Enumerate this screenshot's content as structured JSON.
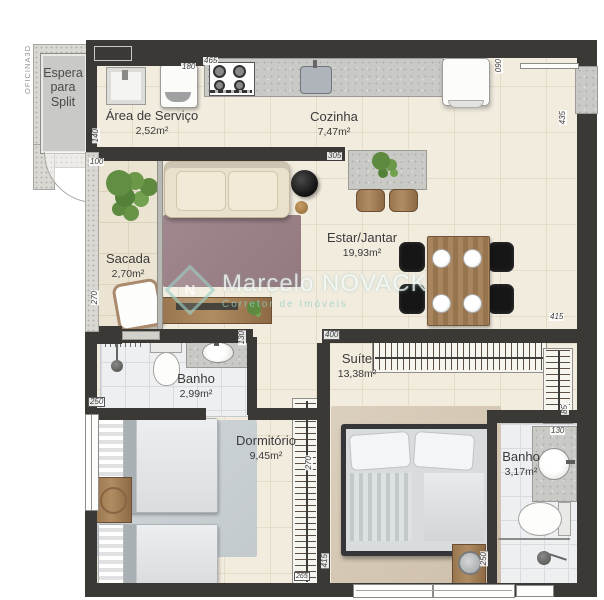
{
  "meta": {
    "brand": "OFICINA3D",
    "type": "apartment floor plan"
  },
  "watermark": {
    "title": "Marcelo NOVACK",
    "subtitle": "Corretor de Imóveis",
    "accent_color": "#96cdc3"
  },
  "colors": {
    "wall": "#3a3936",
    "floor": "#f2ecdf",
    "bath_floor": "#edeff1",
    "granite": "#c9c9c5",
    "rug_living": "#9c8289",
    "rug_bedroom": "#ccd2d5",
    "rug_suite": "#d6c9b6",
    "wood": "#9a7650"
  },
  "rooms": {
    "espera": {
      "name": "Espera para Split",
      "area": ""
    },
    "area_servico": {
      "name": "Área de Serviço",
      "area": "2,52m²"
    },
    "cozinha": {
      "name": "Cozinha",
      "area": "7,47m²"
    },
    "sacada": {
      "name": "Sacada",
      "area": "2,70m²"
    },
    "estar": {
      "name": "Estar/Jantar",
      "area": "19,93m²"
    },
    "banho1": {
      "name": "Banho",
      "area": "2,99m²"
    },
    "dormitorio": {
      "name": "Dormitório",
      "area": "9,45m²"
    },
    "suite": {
      "name": "Suíte",
      "area": "13,38m²"
    },
    "banho2": {
      "name": "Banho",
      "area": "3,17m²"
    }
  },
  "dimensions": [
    {
      "value": "465"
    },
    {
      "value": "180"
    },
    {
      "value": "090"
    },
    {
      "value": "435"
    },
    {
      "value": "140"
    },
    {
      "value": "100"
    },
    {
      "value": "305"
    },
    {
      "value": "270"
    },
    {
      "value": "415"
    },
    {
      "value": "400"
    },
    {
      "value": "130"
    },
    {
      "value": "250"
    },
    {
      "value": "270"
    },
    {
      "value": "85"
    },
    {
      "value": "130"
    },
    {
      "value": "415"
    },
    {
      "value": "250"
    },
    {
      "value": "265"
    }
  ],
  "furniture_icons": [
    "laundry-sink",
    "washing-machine",
    "cooktop",
    "kitchen-sink",
    "refrigerator",
    "kitchen-island",
    "bar-stool",
    "sofa",
    "side-table",
    "tv-console",
    "balcony-plant",
    "balcony-chair",
    "dining-table",
    "dining-chair",
    "plate",
    "shower",
    "toilet",
    "vanity-sink",
    "single-bed",
    "nightstand",
    "wardrobe",
    "closet-rack",
    "double-bed",
    "door-swing",
    "window"
  ]
}
